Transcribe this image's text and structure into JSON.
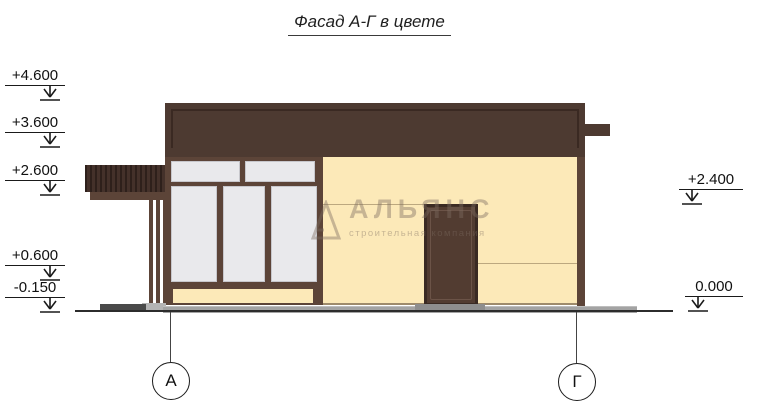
{
  "title": "Фасад А-Г в цвете",
  "watermark": {
    "name": "АЛЬЯНС",
    "subtitle": "строительная компания"
  },
  "elevations": {
    "left": [
      {
        "value": "+4.600"
      },
      {
        "value": "+3.600"
      },
      {
        "value": "+2.600"
      },
      {
        "value": "+0.600"
      },
      {
        "value": "-0.150"
      }
    ],
    "right": [
      {
        "value": "+2.400"
      },
      {
        "value": "0.000"
      }
    ]
  },
  "axes": [
    {
      "label": "А"
    },
    {
      "label": "Г"
    }
  ],
  "colors": {
    "roof": "#4d3a31",
    "roofline": "#3a2922",
    "frame": "#5c4438",
    "wall": "#fce9b8",
    "window": "#e9e9ec",
    "winborder": "#c7c7cc",
    "door": "#523c31",
    "doorframe": "#3a2a23",
    "awning": "#44312a",
    "awningstripe": "#2e201b",
    "plinth": "#a3a3a3",
    "threshold": "#8e8e8e",
    "path": "#4a4a4a",
    "ground": "#2c2c2c",
    "line": "#1a1a1a",
    "seam": "#bca87f",
    "watermark": "#7d6d61"
  }
}
